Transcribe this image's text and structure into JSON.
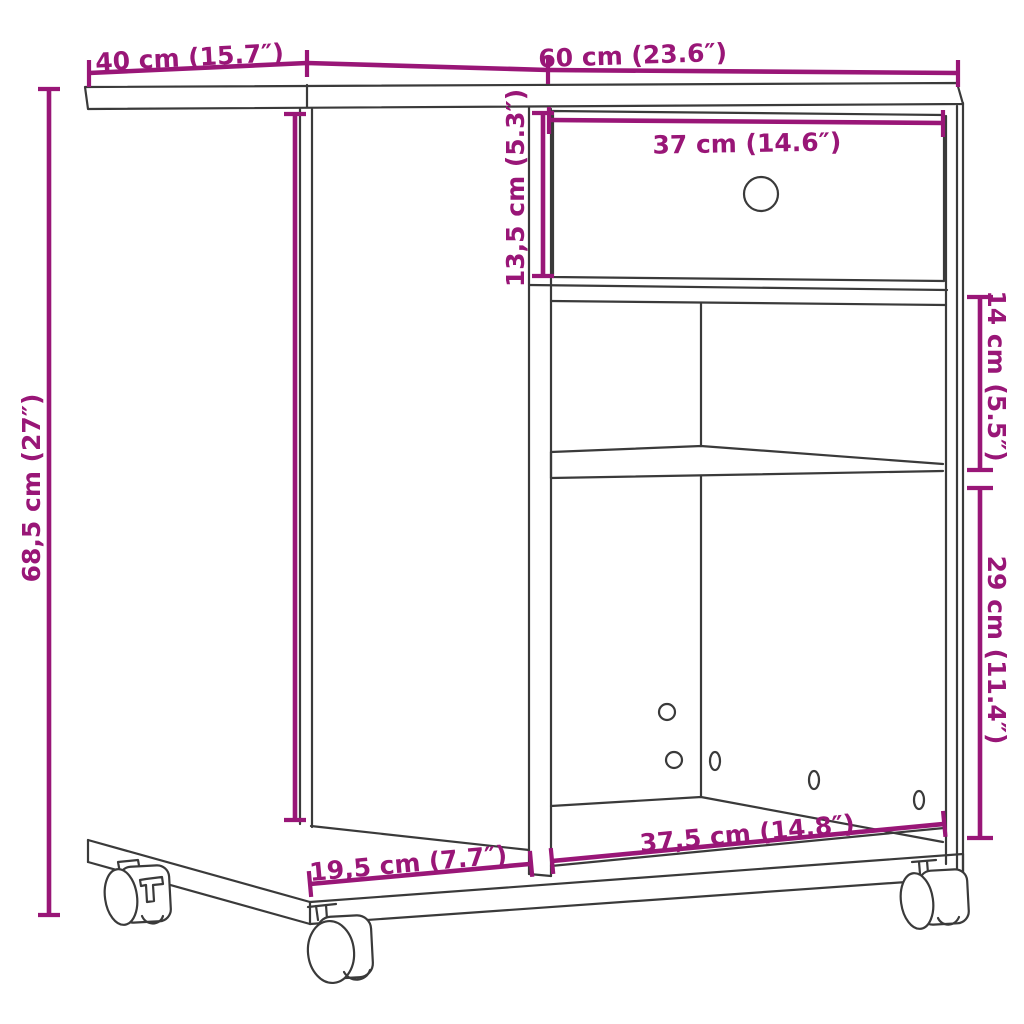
{
  "diagram": {
    "kind": "furniture-dimension-diagram",
    "subject": "rolling side table with drawer, open shelves and casters",
    "background_color": "#ffffff",
    "line_color": "#3a3a3a",
    "accent_color": "#991677",
    "dimensions": {
      "top_left_width": {
        "label": "40 cm (15.7″)"
      },
      "top_right_width": {
        "label": "60 cm (23.6″)"
      },
      "drawer_width": {
        "label": "37 cm (14.6″)"
      },
      "drawer_height": {
        "label": "13,5 cm (5.3″)"
      },
      "total_height": {
        "label": "68,5 cm (27″)"
      },
      "shelf_gap_height": {
        "label": "14 cm (5.5″)"
      },
      "bottom_space_height": {
        "label": "29 cm (11.4″)"
      },
      "base_left_depth": {
        "label": "19,5 cm (7.7″)"
      },
      "base_right_width": {
        "label": "37,5 cm (14.8″)"
      }
    }
  }
}
